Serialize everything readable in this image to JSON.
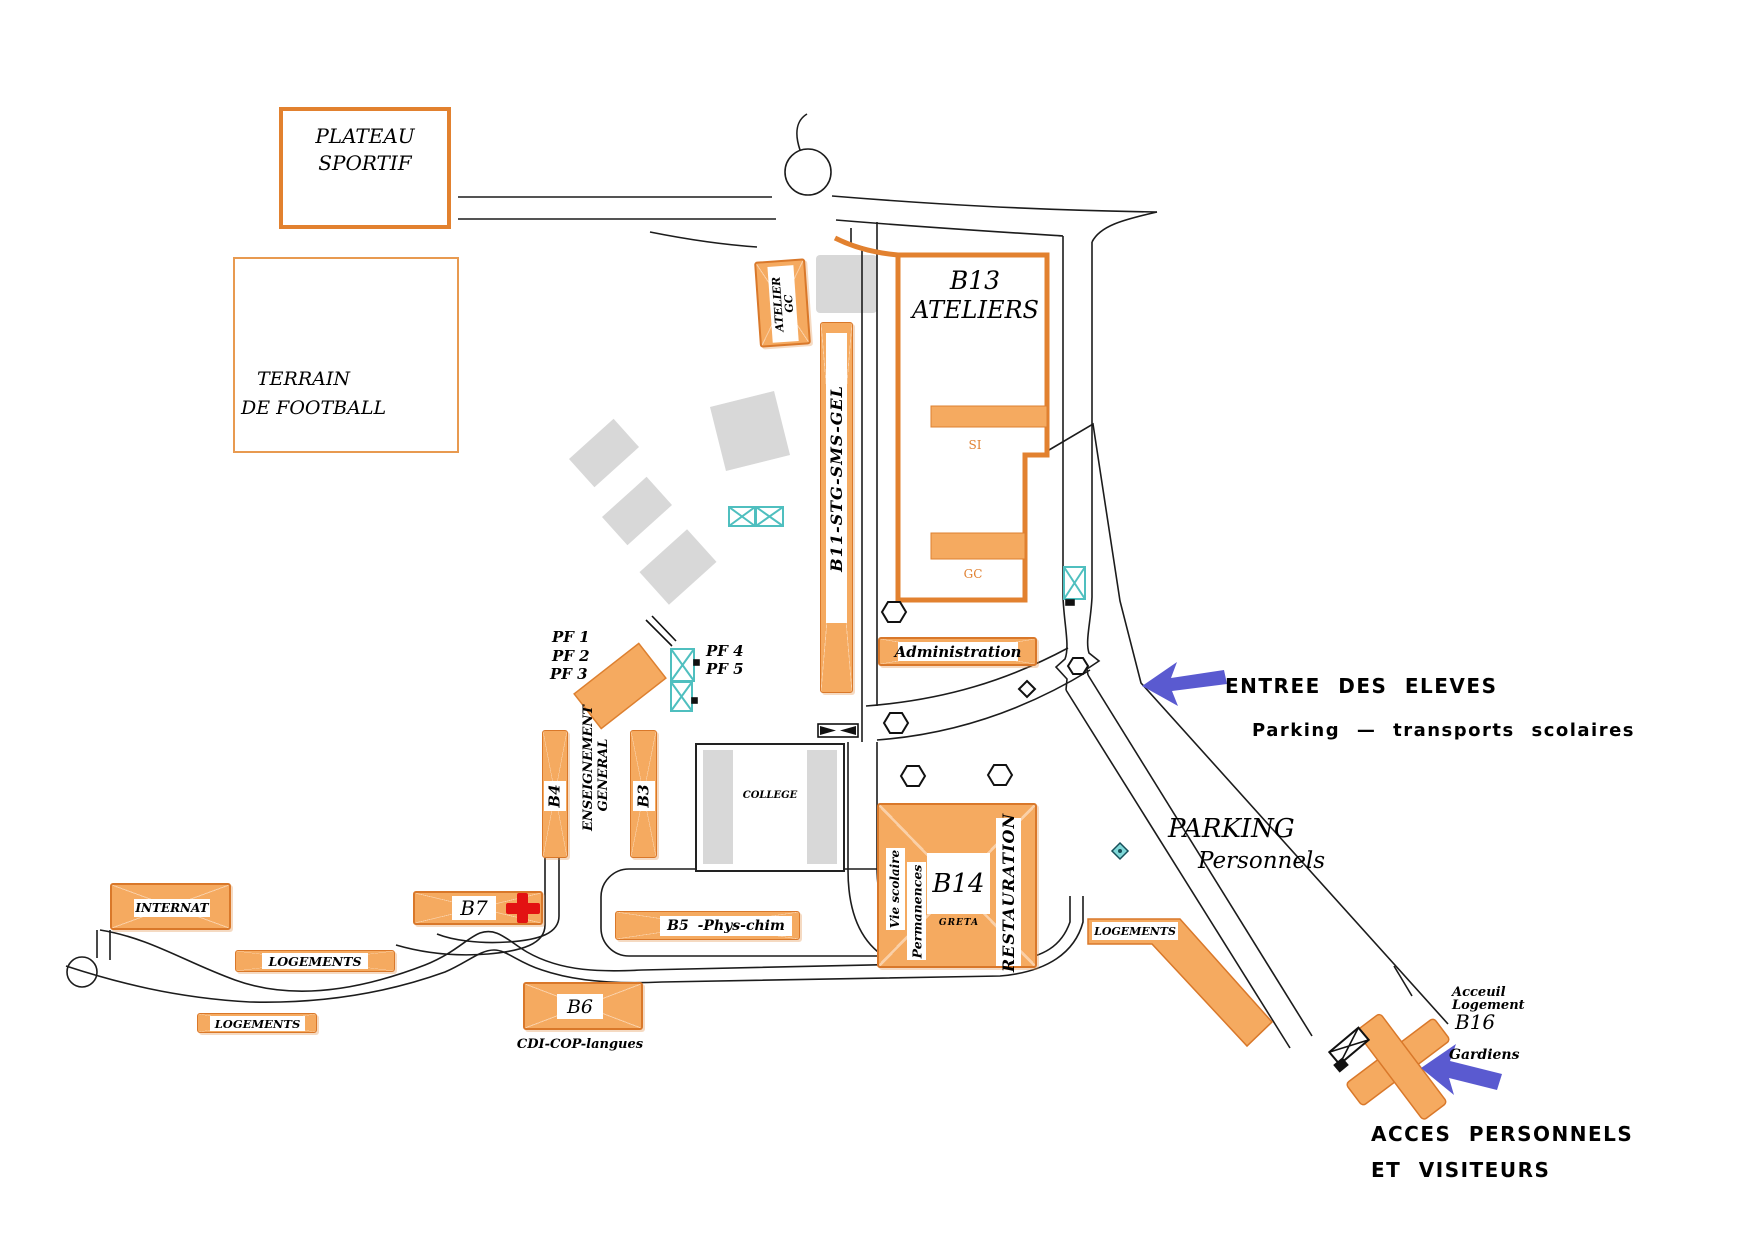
{
  "map": {
    "zones": {
      "plateau_sportif": {
        "line1": "PLATEAU",
        "line2": "SPORTIF"
      },
      "terrain_football": {
        "line1": "TERRAIN",
        "line2": "DE  FOOTBALL"
      }
    },
    "buildings": {
      "atelier_gc": {
        "line1": "ATELIER",
        "line2": "GC"
      },
      "b13": {
        "name": "B13",
        "type": "ATELIERS",
        "wing_si": "SI",
        "wing_gc": "GC"
      },
      "b11": {
        "label": "B11-STG-SMS-GEL"
      },
      "administration": {
        "label": "Administration"
      },
      "b4": {
        "label": "B4"
      },
      "b3": {
        "label": "B3"
      },
      "enseignement_general": {
        "line1": "ENSEIGNEMENT",
        "line2": "GENERAL"
      },
      "college": {
        "label": "COLLEGE"
      },
      "b14": {
        "label": "B14",
        "greta": "GRETA",
        "vie_scolaire": "Vie scolaire",
        "permanences": "Permanences",
        "restauration": "RESTAURATION"
      },
      "b7": {
        "label": "B7"
      },
      "b5": {
        "label": "B5  -Phys-chim"
      },
      "b6": {
        "label": "B6",
        "caption": "CDI-COP-langues"
      },
      "internat": {
        "label": "INTERNAT"
      },
      "logements_west_1": {
        "label": "LOGEMENTS"
      },
      "logements_west_2": {
        "label": "LOGEMENTS"
      },
      "logements_east": {
        "label": "LOGEMENTS"
      },
      "b16": {
        "line1": "Acceuil",
        "line2": "Logement",
        "line3": "B16"
      }
    },
    "labels": {
      "pf_west": [
        "PF  1",
        "PF  2",
        "PF  3"
      ],
      "pf_east": [
        "PF  4",
        "PF  5"
      ],
      "parking_staff": {
        "line1": "PARKING",
        "line2": "Personnels"
      },
      "gardiens": "Gardiens",
      "entrance_students": {
        "line1": "ENTREE DES ELEVES",
        "line2": "Parking — transports scolaires"
      },
      "entrance_staff": {
        "line1": "ACCES PERSONNELS",
        "line2": "ET VISITEURS"
      }
    },
    "colors": {
      "building_fill": "#F5AA60",
      "building_border": "#D9782A",
      "arrow_blue": "#5A5AD0",
      "gate_cyan": "#4FBFBF",
      "first_aid_red": "#E31212",
      "shadow_gray": "#D8D8D8"
    }
  }
}
